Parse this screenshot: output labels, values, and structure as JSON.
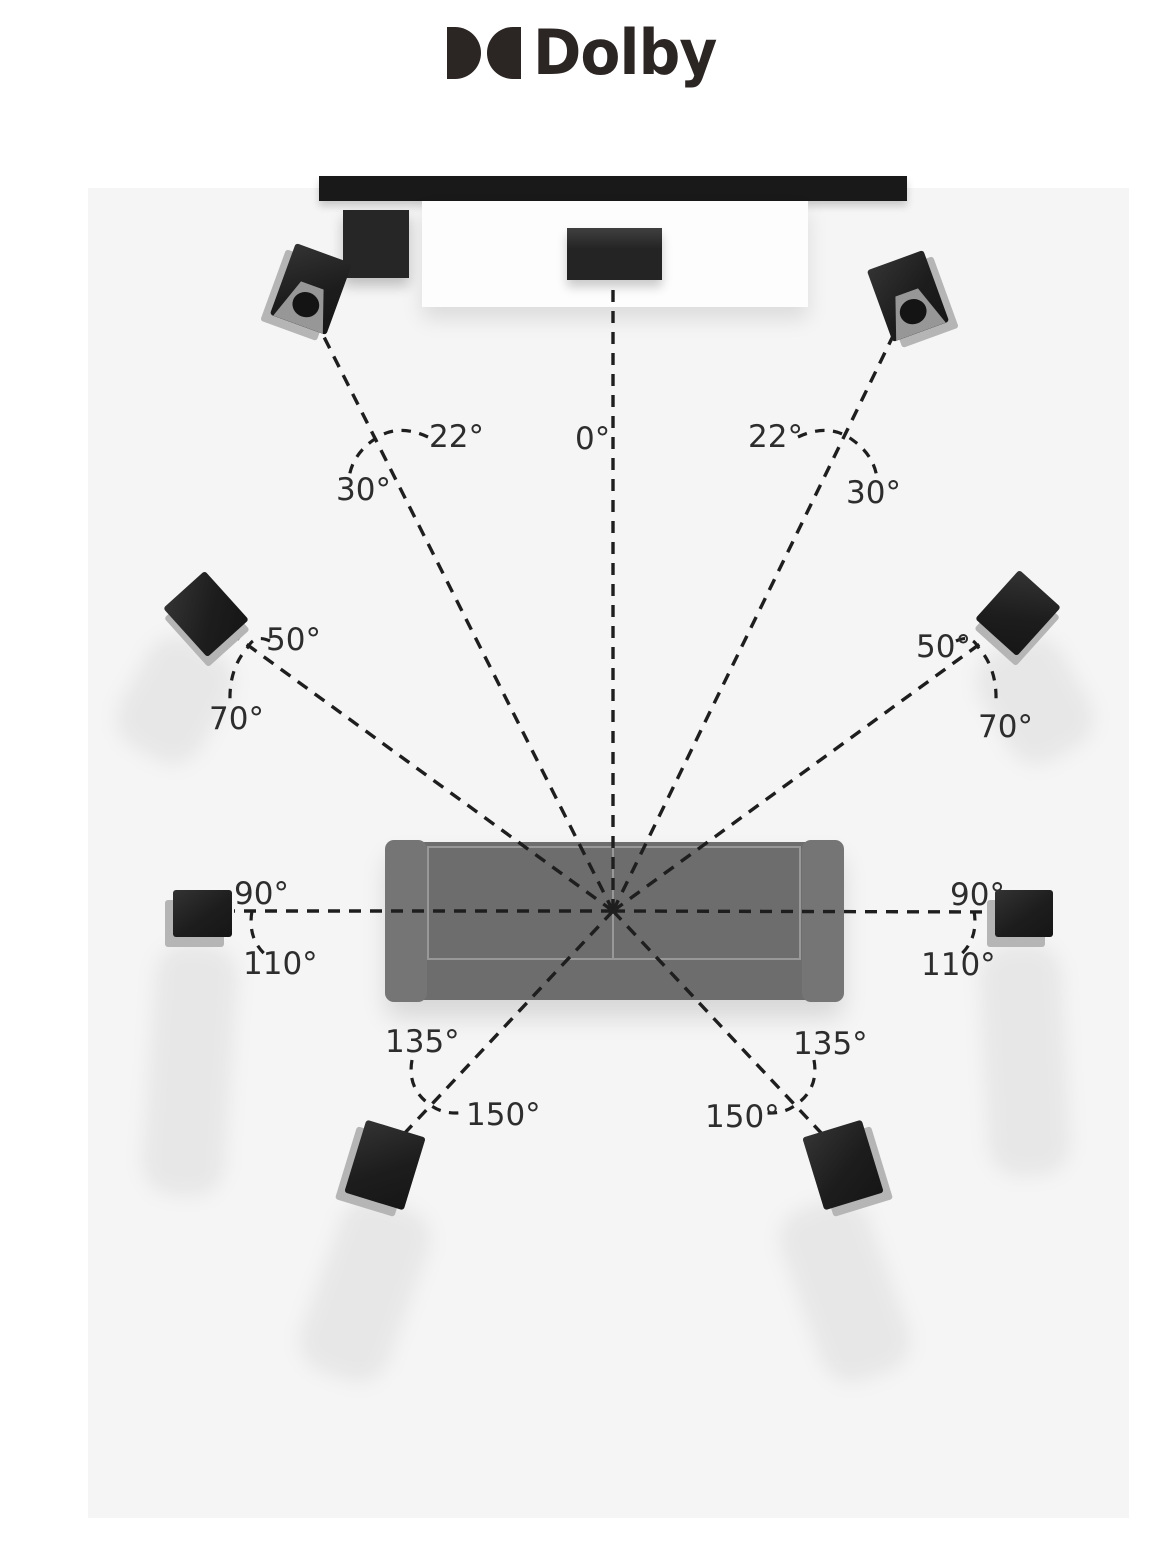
{
  "brand": {
    "name": "Dolby",
    "logo_mark": "double-d-icon",
    "color": "#2b2523"
  },
  "diagram": {
    "title_semantic": "dolby-speaker-placement-top-view",
    "colors": {
      "room_bg": "#f5f5f5",
      "page_bg": "#ffffff",
      "line": "#1e1e1e",
      "speaker": "#1d1d1d",
      "sofa": "#6d6d6d"
    },
    "furniture": [
      "tv-screen",
      "media-console",
      "component-box",
      "sofa"
    ],
    "speakers": [
      "center-speaker",
      "front-left-speaker",
      "front-right-speaker",
      "wide-left-speaker",
      "wide-right-speaker",
      "side-left-speaker",
      "side-right-speaker",
      "rear-left-speaker",
      "rear-right-speaker"
    ],
    "labels": {
      "center": "0°",
      "front_left": {
        "min": "22°",
        "max": "30°"
      },
      "front_right": {
        "min": "22°",
        "max": "30°"
      },
      "wide_left": {
        "min": "50°",
        "max": "70°"
      },
      "wide_right": {
        "min": "50°",
        "max": "70°"
      },
      "side_left": {
        "min": "90°",
        "max": "110°"
      },
      "side_right": {
        "min": "90°",
        "max": "110°"
      },
      "rear_left": {
        "min": "135°",
        "max": "150°"
      },
      "rear_right": {
        "min": "135°",
        "max": "150°"
      }
    }
  }
}
